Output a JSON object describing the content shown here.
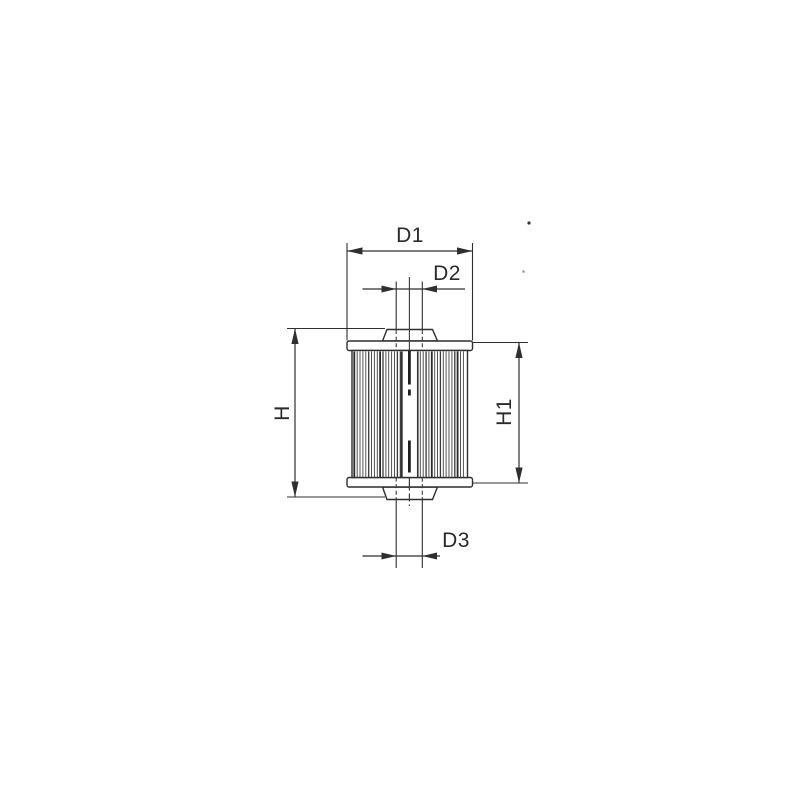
{
  "drawing": {
    "kind": "dimensioned-part-drawing",
    "labels": {
      "d1": "D1",
      "d2": "D2",
      "d3": "D3",
      "h": "H",
      "h1": "H1"
    },
    "colors": {
      "background": "#ffffff",
      "line": "#2f2f2f",
      "text": "#2a2a2a"
    }
  }
}
